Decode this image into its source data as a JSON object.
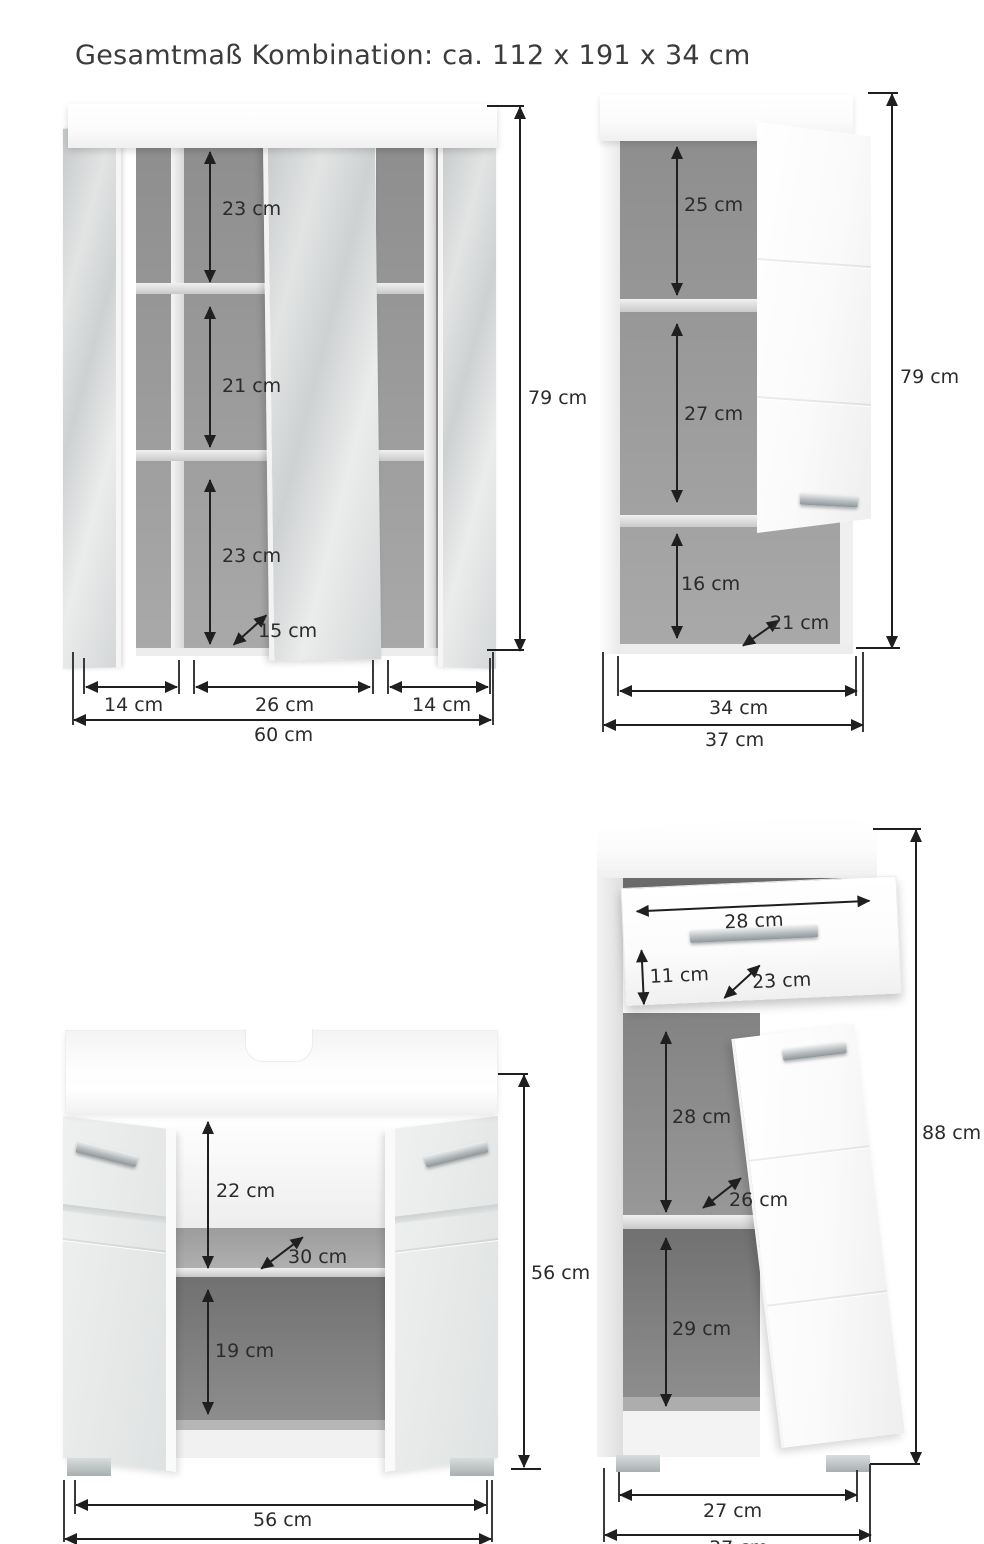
{
  "title": "Gesamtmaß Kombination: ca. 112 x 191 x 34 cm",
  "mirror_cabinet": {
    "shelf_top": "23 cm",
    "shelf_middle": "21 cm",
    "shelf_bottom": "23 cm",
    "depth": "15 cm",
    "width_left_door": "14 cm",
    "width_center_door": "26 cm",
    "width_right_door": "14 cm",
    "width_total": "60 cm",
    "height": "79 cm"
  },
  "wall_cabinet": {
    "compartment_top": "25 cm",
    "compartment_middle": "27 cm",
    "compartment_bottom": "16 cm",
    "depth": "21 cm",
    "width_inner": "34 cm",
    "width_total": "37 cm",
    "height": "79 cm"
  },
  "sink_cabinet": {
    "compartment_top": "22 cm",
    "depth": "30 cm",
    "compartment_bottom": "19 cm",
    "width_inner": "56 cm",
    "height": "56 cm"
  },
  "tall_cabinet": {
    "drawer_width": "28 cm",
    "drawer_front_height": "11 cm",
    "drawer_depth": "23 cm",
    "compartment_middle": "28 cm",
    "depth": "26 cm",
    "compartment_bottom": "29 cm",
    "width_inner": "27 cm",
    "width_total": "37 cm",
    "height": "88 cm"
  }
}
